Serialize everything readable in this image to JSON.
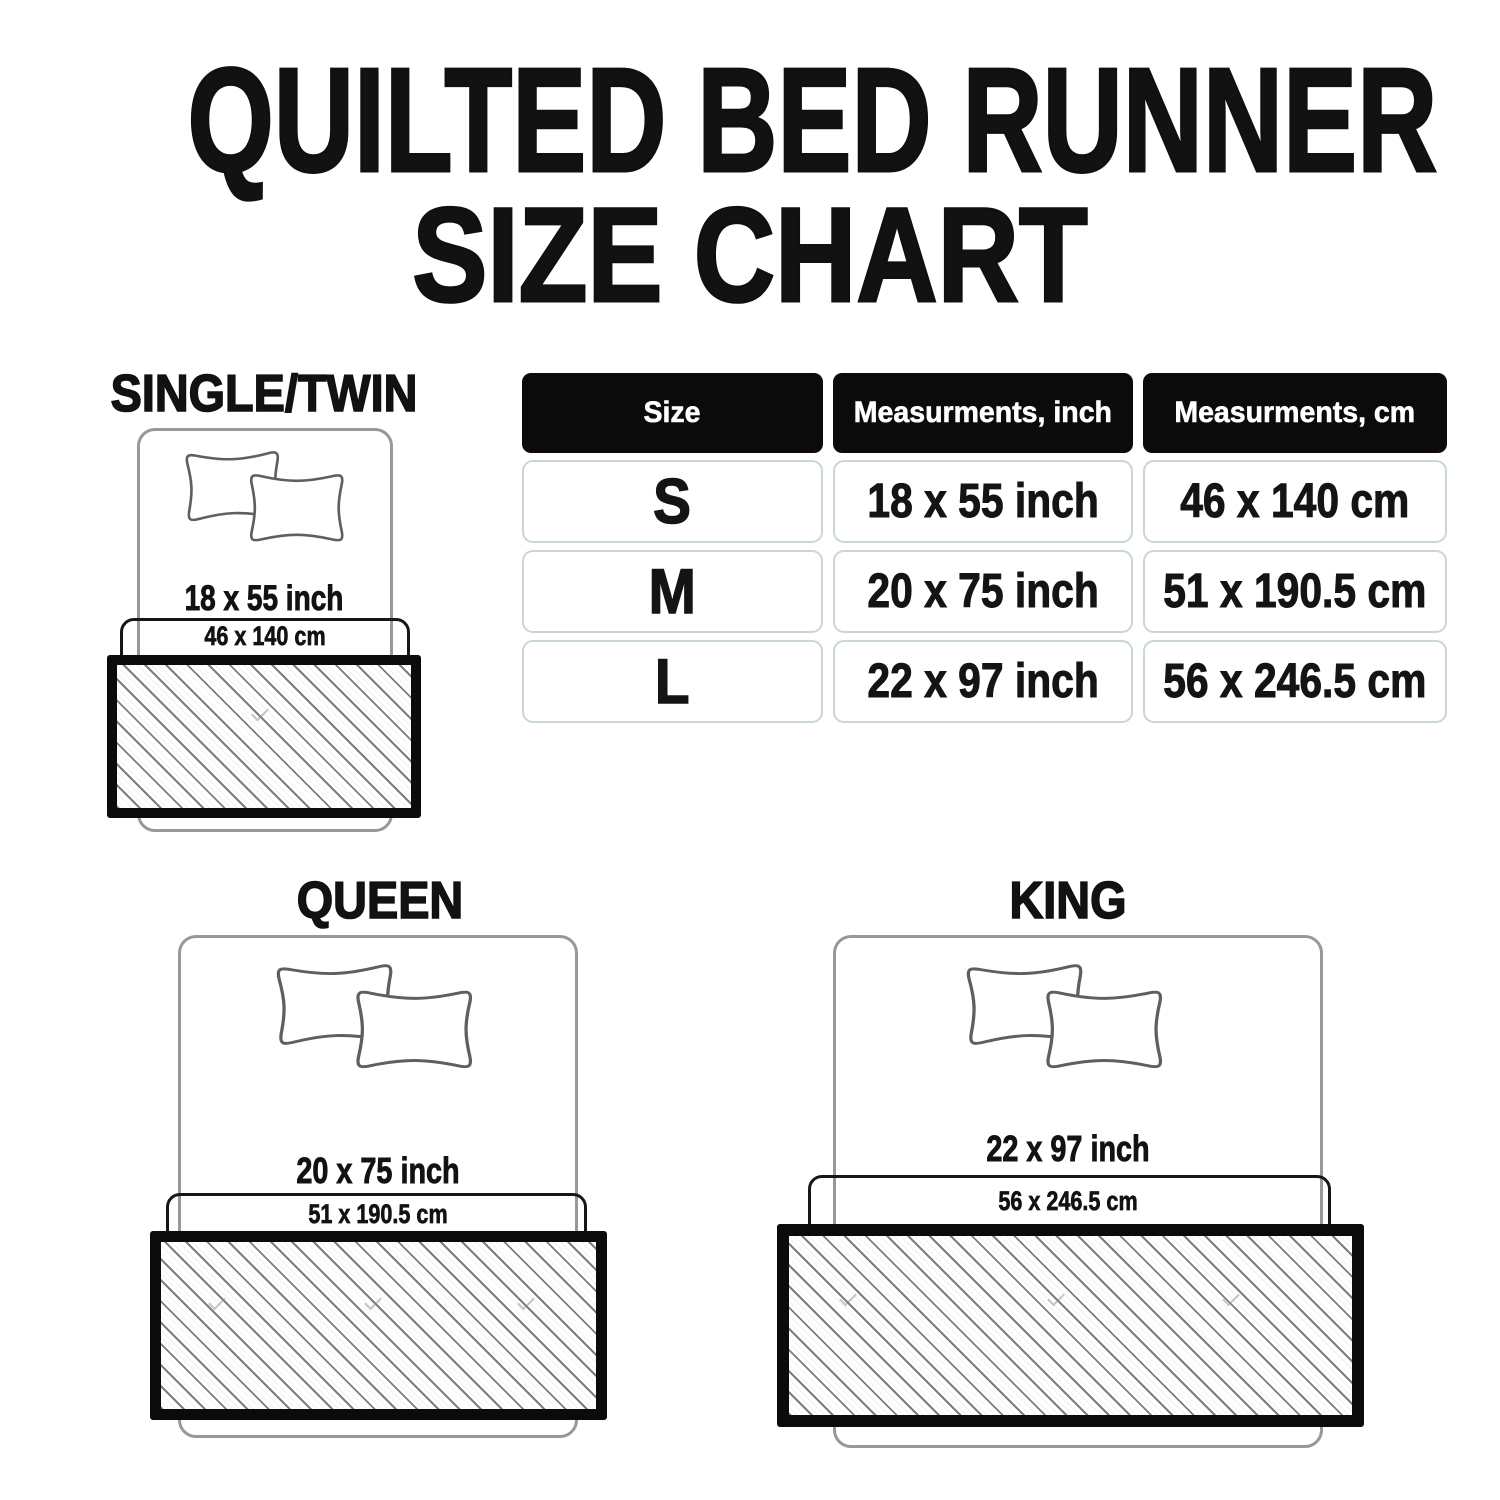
{
  "title": {
    "line1": "QUILTED BED RUNNER",
    "line2": "SIZE CHART"
  },
  "table": {
    "headers": [
      "Size",
      "Measurments, inch",
      "Measurments, cm"
    ],
    "rows": [
      {
        "size": "S",
        "inch": "18 x 55 inch",
        "cm": "46 x 140 cm"
      },
      {
        "size": "M",
        "inch": "20 x 75 inch",
        "cm": "51 x 190.5 cm"
      },
      {
        "size": "L",
        "inch": "22 x 97 inch",
        "cm": "56 x 246.5 cm"
      }
    ]
  },
  "diagrams": {
    "single": {
      "label": "SINGLE/TWIN",
      "inch": "18 x 55 inch",
      "cm": "46 x 140 cm"
    },
    "queen": {
      "label": "QUEEN",
      "inch": "20 x 75 inch",
      "cm": "51 x 190.5 cm"
    },
    "king": {
      "label": "KING",
      "inch": "22 x 97 inch",
      "cm": "56 x 246.5 cm"
    }
  },
  "colors": {
    "background": "#ffffff",
    "text": "#121212",
    "table_header_bg": "#0b0b0b",
    "table_header_text": "#ffffff",
    "table_row_border": "#c9d6d9",
    "bed_outline": "#989898",
    "pillow_outline": "#5f5f5f",
    "measurement_outline": "#161616",
    "runner_border": "#0b0b0b",
    "hatch_line": "#7d7d7d"
  }
}
